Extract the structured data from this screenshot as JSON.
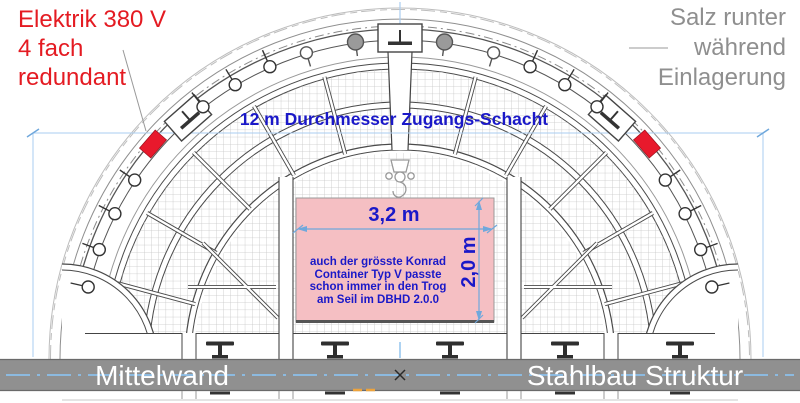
{
  "annotations": {
    "elektrik": "Elektrik 380 V\n4 fach\nredundant",
    "salz_runter": "Salz runter\nwährend\nEinlagerung",
    "shaft_diameter": "12 m Durchmesser Zugangs-Schacht"
  },
  "trough": {
    "width_label": "3,2 m",
    "height_label": "2,0 m",
    "note": "auch der grösste Konrad\nContainer Typ V passte\nschon immer in den Trog\nam Seil im DBHD 2.0.0"
  },
  "footer": {
    "left_label": "Mittelwand",
    "right_label": "Stahlbau Struktur"
  },
  "colors": {
    "annotation_red": "#e41b22",
    "annotation_gray": "#8f8f8f",
    "dimension_text_blue": "#1a18c8",
    "dimension_line_blue": "#6fa8dc",
    "light_dim_blue": "#aacdf0",
    "trough_pink": "#f5bfc3",
    "electric_box_red": "#e8192c",
    "footer_bar_gray": "#909090",
    "orange_marker": "#eda33c"
  },
  "icons": {
    "lamp_marker": "open-circle-with-radial-stem",
    "cable_marker": "gray-filled-circle-with-stem",
    "anchor_block": "rectangle-with-i-beam",
    "crane_hook": "pulley-and-hook",
    "steel_beam": "i-beam-tee",
    "center_mark": "x-cross"
  }
}
